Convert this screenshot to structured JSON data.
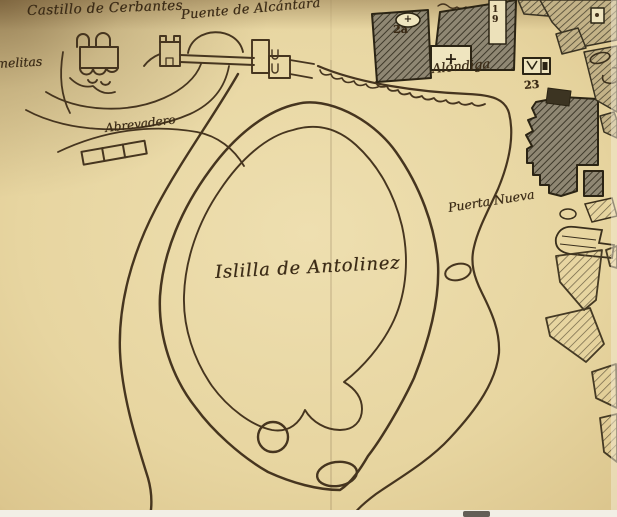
{
  "map": {
    "labels": {
      "castillo": "Castillo de Cerbantes",
      "puente": "Puente de Alcántara",
      "carmelitas_fragment": "melitas",
      "abrevadero": "Abrevadero",
      "alondiga": "Alóndiga",
      "puerta_nueva": "Puerta Nueva",
      "islilla": "Islilla de Antolinez"
    },
    "markers": {
      "n2a": "2a",
      "n19": "19",
      "n23": "23",
      "cross": "+"
    },
    "colors": {
      "paper": "#e7d5a0",
      "paper_edge": "#c5ab74",
      "ink": "#46351f",
      "building_fill": "#8f8773",
      "hatch_line": "#3e392a",
      "label_ink": "#3a2a15",
      "bottom_margin": "#f2efe6"
    },
    "icons": {
      "castle": "castle-outline-icon",
      "bridge": "bridge-with-towers-icon",
      "trough": "water-trough-icon",
      "cross_oval": "oval-cross-marker",
      "cross_box": "box-cross-marker",
      "gate_symbol": "gate-box-marker"
    }
  }
}
